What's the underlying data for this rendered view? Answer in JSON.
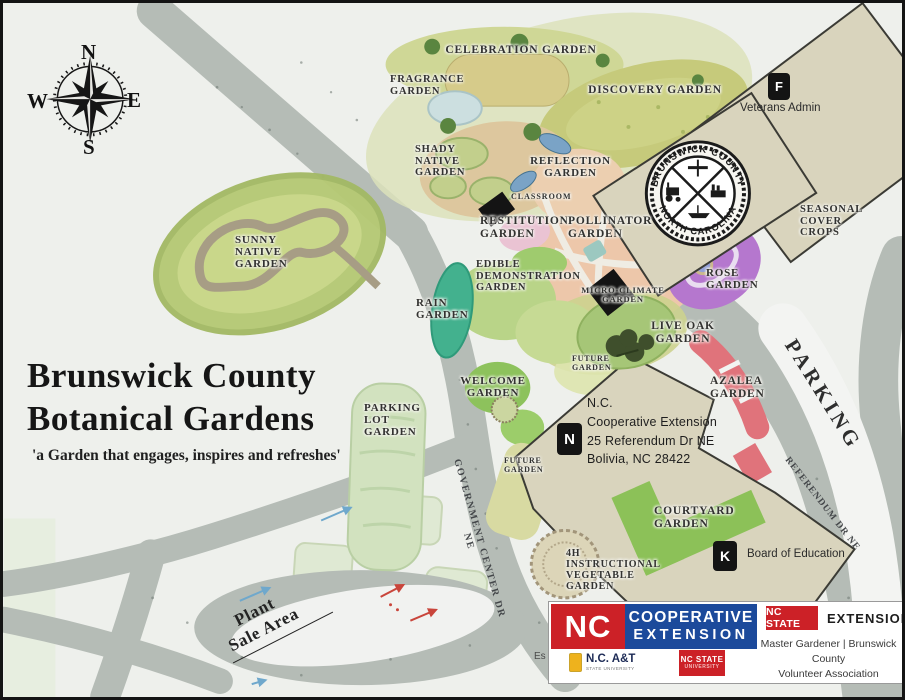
{
  "title": {
    "line1": "Brunswick County",
    "line2": "Botanical Gardens",
    "tagline": "'a Garden that engages, inspires and refreshes'"
  },
  "compass": {
    "north": "N",
    "east": "E",
    "south": "S",
    "west": "W"
  },
  "seal": {
    "arc_top": "BRUNSWICK COUNTY",
    "arc_bottom": "NORTH CAROLINA"
  },
  "gardens": {
    "celebration": "CELEBRATION GARDEN",
    "fragrance": "FRAGRANCE\nGARDEN",
    "discovery": "DISCOVERY GARDEN",
    "shady_native": "SHADY\nNATIVE\nGARDEN",
    "reflection": "REFLECTION\nGARDEN",
    "classroom": "CLASSROOM",
    "restitution": "RESTITUTION\nGARDEN",
    "pollinator": "POLLINATOR\nGARDEN",
    "seasonal_cover": "SEASONAL\nCOVER\nCROPS",
    "sunny_native": "SUNNY\nNATIVE\nGARDEN",
    "edible_demo": "EDIBLE\nDEMONSTRATION\nGARDEN",
    "rain": "RAIN\nGARDEN",
    "micro_climate": "MICRO-CLIMATE\nGARDEN",
    "rose": "ROSE\nGARDEN",
    "live_oak": "LIVE OAK\nGARDEN",
    "future_1": "FUTURE\nGARDEN",
    "azalea": "AZALEA\nGARDEN",
    "welcome": "WELCOME\nGARDEN",
    "parking_lot": "PARKING\nLOT\nGARDEN",
    "future_2": "FUTURE\nGARDEN",
    "courtyard": "COURTYARD\nGARDEN",
    "veg_4h": "4H\nINSTRUCTIONAL\nVEGETABLE\nGARDEN"
  },
  "areas": {
    "parking": "PARKING",
    "plant_sale": "Plant\nSale Area"
  },
  "roads": {
    "government_center": "GOVERNMENT CENTER DR NE",
    "referendum": "REFERENDUM DR NE"
  },
  "buildings": {
    "veterans": {
      "badge": "F",
      "label": "Veterans Admin"
    },
    "extension": {
      "badge": "N",
      "address": "N.C.\nCooperative Extension\n25 Referendum Dr NE\nBolivia, NC 28422"
    },
    "education": {
      "badge": "K",
      "label": "Board of Education"
    }
  },
  "footer": {
    "nc_block": "NC",
    "coop_line1": "COOPERATIVE",
    "coop_line2": "EXTENSION",
    "ncat_name": "N.C. A&T",
    "ncat_sub": "STATE UNIVERSITY",
    "ncstate_small_line1": "NC STATE",
    "ncstate_small_line2": "UNIVERSITY",
    "ncstate_badge": "NC STATE",
    "extension_word": "EXTENSION",
    "association": "Master Gardener | Brunswick County\nVolunteer Association",
    "stray_text": "Es"
  },
  "colors": {
    "brand_red": "#cc2127",
    "brand_blue": "#1c4a9b",
    "road_gray": "#b5bcb6",
    "building_tan": "#d9d4bd",
    "rose_purple": "#b577ce",
    "azalea_red": "#e0737b",
    "seasonal_teal": "#90d3b3"
  }
}
